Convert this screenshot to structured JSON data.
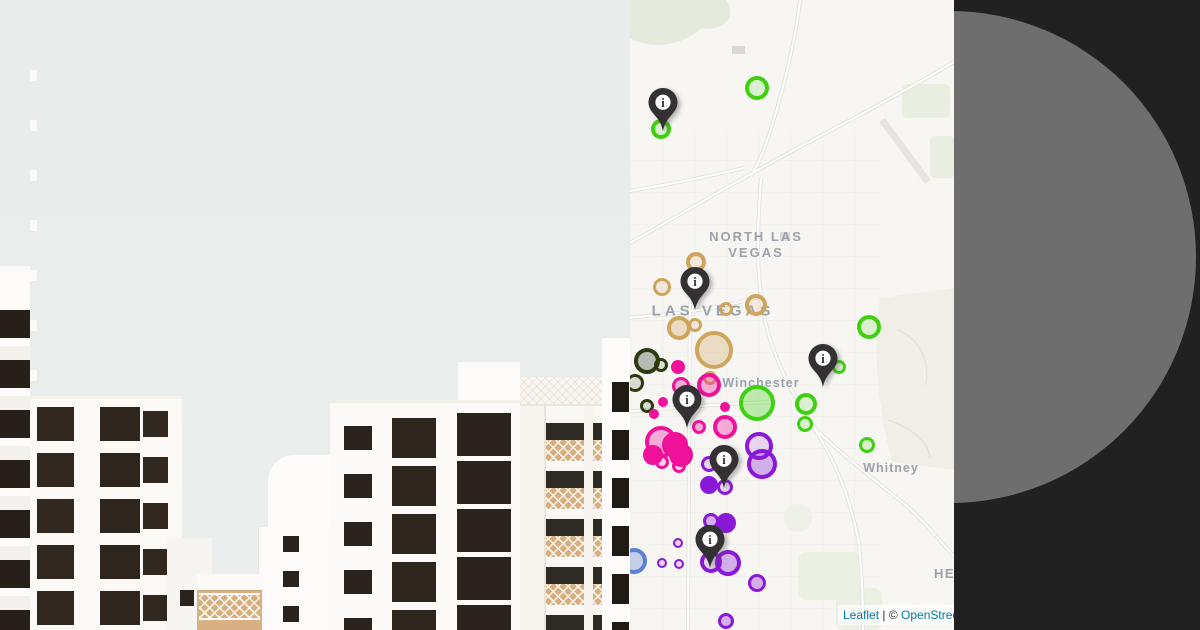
{
  "map": {
    "labels": [
      {
        "lines": [
          "NORTH LAS",
          "VEGAS"
        ],
        "x": 126,
        "y": 245,
        "size": 13,
        "spacing": 2
      },
      {
        "lines": [
          "LAS VEGAS"
        ],
        "x": 83,
        "y": 312,
        "size": 15,
        "spacing": 4
      },
      {
        "lines": [
          "Winchester"
        ],
        "x": 131,
        "y": 384,
        "size": 12.5,
        "spacing": 1
      },
      {
        "lines": [
          "Whitney"
        ],
        "x": 261,
        "y": 469,
        "size": 12.5,
        "spacing": 1
      },
      {
        "lines": [
          "HEN"
        ],
        "x": 320,
        "y": 574,
        "size": 13,
        "spacing": 1.5
      }
    ],
    "attribution": {
      "leaflet": "Leaflet",
      "separator": " | ",
      "copyright": "© ",
      "osm": "OpenStreetMap"
    },
    "colors": {
      "green": "#3fd111",
      "tan": "#cfa55e",
      "olive": "#2c3a10",
      "magenta": "#f0119b",
      "purple": "#8a18d8",
      "blue": "#5b80d5",
      "pin": "#333134",
      "olive_fill": "#b7bbb3"
    },
    "markers": [
      [
        127,
        88,
        12,
        "green",
        "ring"
      ],
      [
        31,
        129,
        10,
        "green",
        "ring"
      ],
      [
        239,
        327,
        12,
        "green",
        "ring"
      ],
      [
        209,
        367,
        7,
        "green",
        "ring"
      ],
      [
        127,
        403,
        18,
        "green",
        "light"
      ],
      [
        176,
        404,
        11,
        "green",
        "ring"
      ],
      [
        175,
        424,
        8,
        "green",
        "ring"
      ],
      [
        237,
        445,
        8,
        "green",
        "ring"
      ],
      [
        66,
        262,
        10,
        "tan",
        "ring"
      ],
      [
        32,
        287,
        9,
        "tan",
        "ring"
      ],
      [
        96,
        309,
        7,
        "tan",
        "ring"
      ],
      [
        126,
        305,
        11,
        "tan",
        "ring"
      ],
      [
        49,
        328,
        12,
        "tan",
        "light"
      ],
      [
        65,
        325,
        7,
        "tan",
        "ring"
      ],
      [
        84,
        350,
        19,
        "tan",
        "light"
      ],
      [
        80,
        378,
        7,
        "tan",
        "ring"
      ],
      [
        17,
        361,
        13,
        "olive",
        "gray"
      ],
      [
        31,
        365,
        7,
        "olive",
        "ring"
      ],
      [
        5,
        383,
        9,
        "olive",
        "ring"
      ],
      [
        17,
        406,
        7,
        "olive",
        "ring"
      ],
      [
        48,
        367,
        7,
        "magenta",
        "solid"
      ],
      [
        51,
        386,
        9,
        "magenta",
        "light"
      ],
      [
        33,
        402,
        5,
        "magenta",
        "solid"
      ],
      [
        24,
        414,
        5,
        "magenta",
        "solid"
      ],
      [
        31,
        442,
        16,
        "magenta",
        "light"
      ],
      [
        45,
        445,
        13,
        "magenta",
        "solid"
      ],
      [
        23,
        455,
        10,
        "magenta",
        "solid"
      ],
      [
        51,
        455,
        12,
        "magenta",
        "solid"
      ],
      [
        32,
        462,
        7,
        "magenta",
        "ring"
      ],
      [
        49,
        466,
        7,
        "magenta",
        "ring"
      ],
      [
        79,
        385,
        12,
        "magenta",
        "light"
      ],
      [
        95,
        407,
        5,
        "magenta",
        "solid"
      ],
      [
        95,
        427,
        12,
        "magenta",
        "light"
      ],
      [
        69,
        427,
        7,
        "magenta",
        "light"
      ],
      [
        129,
        446,
        14,
        "purple",
        "ring"
      ],
      [
        132,
        464,
        15,
        "purple",
        "light"
      ],
      [
        79,
        464,
        8,
        "purple",
        "ring"
      ],
      [
        79,
        485,
        9,
        "purple",
        "solid"
      ],
      [
        95,
        487,
        8,
        "purple",
        "ring"
      ],
      [
        96,
        523,
        10,
        "purple",
        "solid"
      ],
      [
        81,
        521,
        8,
        "purple",
        "light"
      ],
      [
        81,
        562,
        11,
        "purple",
        "ring"
      ],
      [
        98,
        563,
        13,
        "purple",
        "light"
      ],
      [
        127,
        583,
        9,
        "purple",
        "light"
      ],
      [
        96,
        621,
        8,
        "purple",
        "light"
      ],
      [
        48,
        543,
        5,
        "purple",
        "ring"
      ],
      [
        49,
        564,
        5,
        "purple",
        "ring"
      ],
      [
        32,
        563,
        5,
        "purple",
        "ring"
      ],
      [
        4,
        561,
        13,
        "blue",
        "light"
      ]
    ],
    "pins": [
      {
        "x": 33,
        "y": 102
      },
      {
        "x": 65,
        "y": 281
      },
      {
        "x": 57,
        "y": 399
      },
      {
        "x": 193,
        "y": 358
      },
      {
        "x": 94,
        "y": 459
      },
      {
        "x": 80,
        "y": 539
      }
    ],
    "pin_glyph": "i"
  },
  "decor": {
    "panel_bg": "#212121",
    "panel_circle": "#6e6e6e",
    "sky": "#e9edec",
    "map_bg": "#f7f6f3"
  }
}
